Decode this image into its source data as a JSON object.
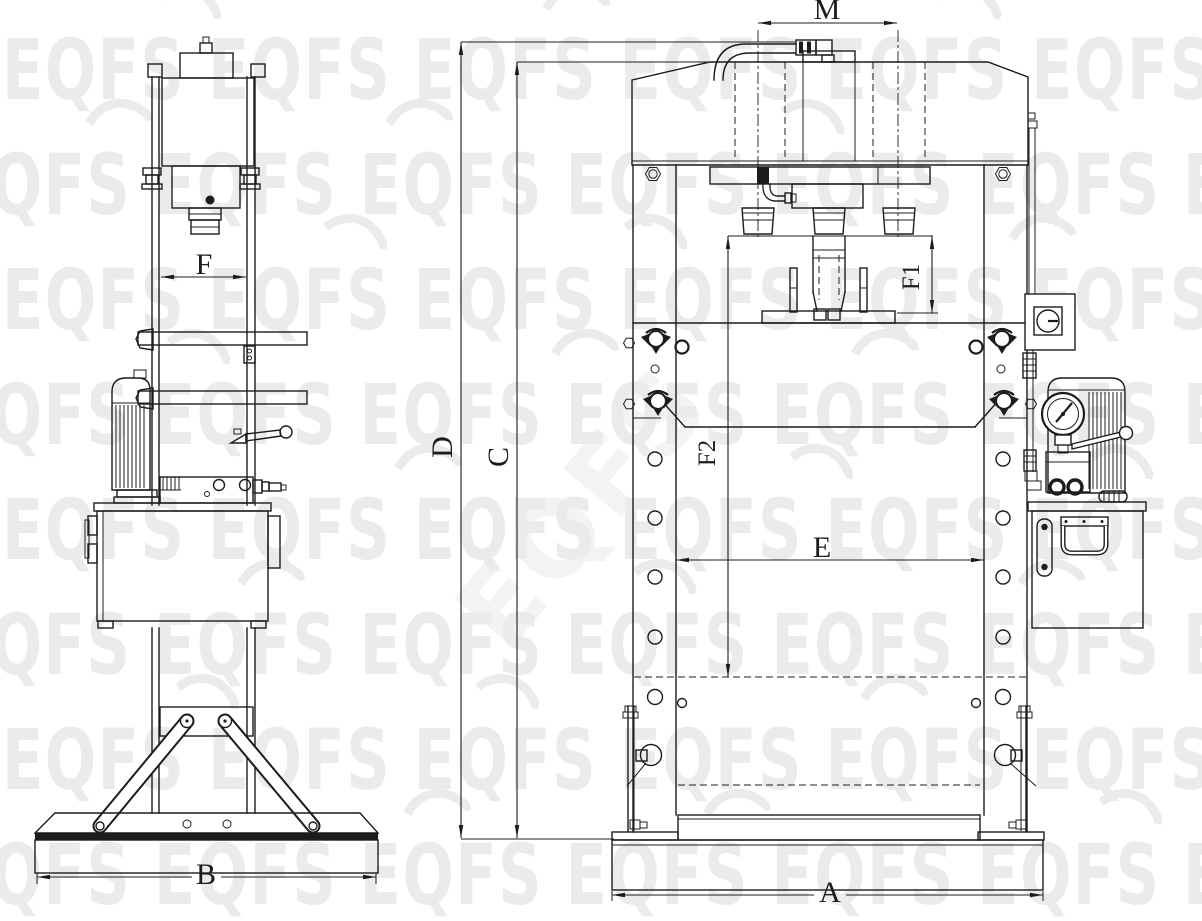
{
  "page": {
    "background": "#ffffff"
  },
  "drawing": {
    "line_color": "#1c1c1c",
    "watermark": {
      "text": "EQFS",
      "color": "#ebebeb"
    },
    "views": {
      "side_view": {
        "dimensions": {
          "F": "F",
          "B": "B"
        }
      },
      "front_view": {
        "dimensions": {
          "M": "M",
          "D": "D",
          "C": "C",
          "F1": "F1",
          "F2": "F2",
          "E": "E",
          "A": "A"
        }
      }
    }
  }
}
